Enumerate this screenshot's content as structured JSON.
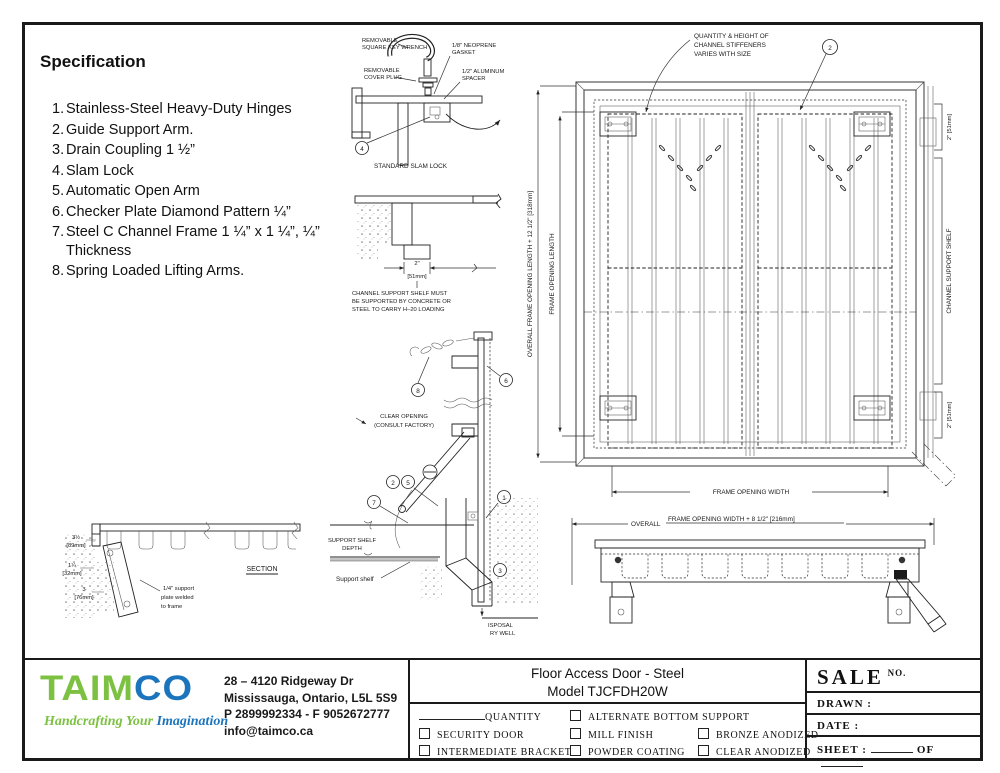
{
  "spec": {
    "title": "Specification",
    "items": [
      {
        "n": "1.",
        "t": "Stainless-Steel Heavy-Duty Hinges"
      },
      {
        "n": "2.",
        "t": "Guide Support Arm."
      },
      {
        "n": "3.",
        "t": "Drain Coupling 1 ½”"
      },
      {
        "n": "4.",
        "t": "Slam Lock"
      },
      {
        "n": "5.",
        "t": "Automatic Open Arm"
      },
      {
        "n": "6.",
        "t": "Checker Plate Diamond Pattern ¼”"
      },
      {
        "n": "7.",
        "t": "Steel C Channel Frame 1 ¼” x 1 ¼”, ¼” Thickness"
      },
      {
        "n": "8.",
        "t": "Spring Loaded Lifting Arms."
      }
    ]
  },
  "plan": {
    "note1": "QUANTITY & HEIGHT OF",
    "note2": "CHANNEL STIFFENERS",
    "note3": "VARIES WITH SIZE",
    "callout2": "2",
    "dim_overall_len": "OVERALL FRAME OPENING LENGTH + 12 1/2\" [318mm]",
    "dim_len": "FRAME OPENING LENGTH",
    "dim_2top": "2\" [51mm]",
    "shelf_label": "CHANNEL SUPPORT SHELF",
    "dim_2bot": "2\" [51mm]",
    "dim_width": "FRAME OPENING WIDTH",
    "dim_overall_w1": "OVERALL",
    "dim_overall_w2": "FRAME OPENING WIDTH + 8 1/2\" [216mm]"
  },
  "slam": {
    "wrench1": "REMOVABLE",
    "wrench2": "SQUARE KEY WRENCH",
    "plug1": "REMOVABLE",
    "plug2": "COVER PLUG",
    "gasket1": "1/8\" NEOPRENE",
    "gasket2": "GASKET",
    "spacer1": "1/2\" ALUMINUM",
    "spacer2": "SPACER",
    "callout": "4",
    "caption": "STANDARD SLAM LOCK"
  },
  "shelf": {
    "dim_in": "2\"",
    "dim_mm": "[51mm]",
    "note1": "CHANNEL SUPPORT SHELF MUST",
    "note2": "BE SUPPORTED BY CONCRETE OR",
    "note3": "STEEL TO CARRY H–20 LOADING"
  },
  "arm": {
    "co1": "CLEAR OPENING",
    "co2": "(CONSULT FACTORY)",
    "ssd1": "SUPPORT SHELF",
    "ssd2": "DEPTH",
    "support_shelf": "Support shelf",
    "dw1": "ISPOSAL",
    "dw2": "RY WELL",
    "c8": "8",
    "c6": "6",
    "c2": "2",
    "c5": "5",
    "c7": "7",
    "c1": "1",
    "c3": "3"
  },
  "section": {
    "caption": "SECTION",
    "d1a": "3½",
    "d1b": "[89mm]",
    "d2a": "1¼",
    "d2b": "[32mm]",
    "d3a": "3",
    "d3b": "[76mm]",
    "note1": "1/4\" support",
    "note2": "plate welded",
    "note3": "to frame"
  },
  "title_block": {
    "logo_green": "TAIM",
    "logo_blue": "CO",
    "tagline_green": "Handcrafting Your ",
    "tagline_blue": "Imagination",
    "address1": "28 – 4120 Ridgeway Dr",
    "address2": "Mississauga, Ontario, L5L 5S9",
    "address3": "P 2899992334 - F 9052672777",
    "address4": "info@taimco.ca",
    "title1": "Floor Access Door - Steel",
    "title2": "Model TJCFDH20W",
    "quantity": "QUANTITY",
    "cb_security": "SECURITY DOOR",
    "cb_bracket": "INTERMEDIATE BRACKET",
    "cb_alt": "ALTERNATE BOTTOM SUPPORT",
    "cb_mill": "MILL FINISH",
    "cb_powder": "POWDER COATING",
    "cb_bronze": "BRONZE ANODIZED",
    "cb_clear": "CLEAR ANODIZED",
    "sale": "SALE",
    "sale_no": "NO.",
    "drawn": "DRAWN :",
    "date": "DATE :",
    "sheet": "SHEET :",
    "of": "OF"
  },
  "colors": {
    "logo_green": "#7CC142",
    "logo_blue": "#1C75BC",
    "line": "#1a1a1a"
  }
}
